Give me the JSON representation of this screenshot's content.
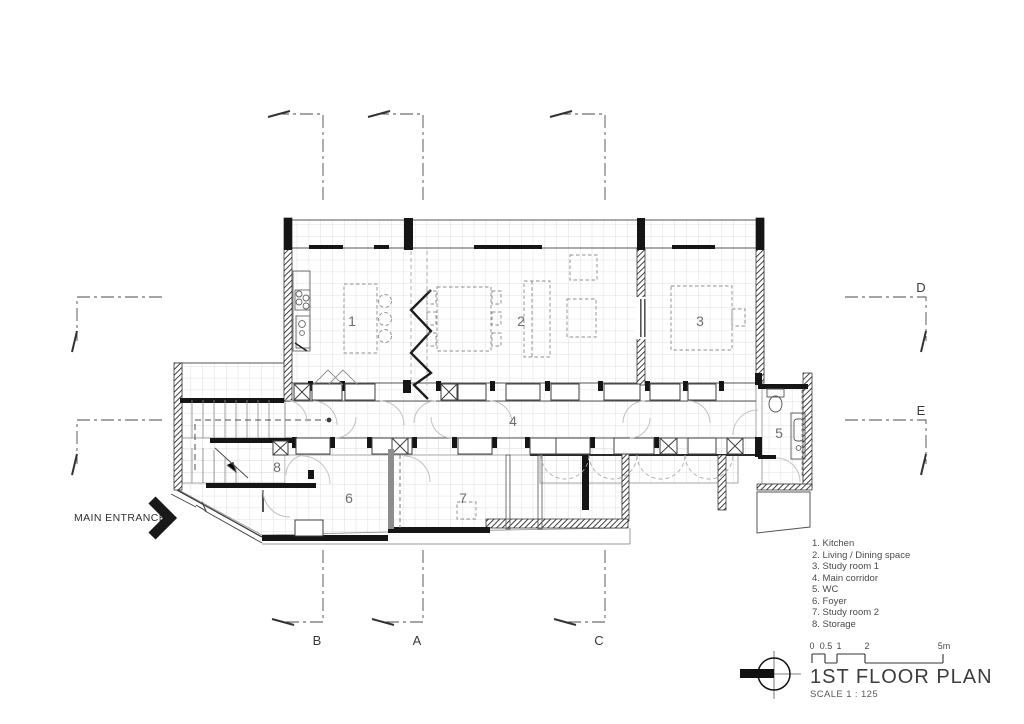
{
  "colors": {
    "background": "#ffffff",
    "line": "#3c3c3c",
    "wall": "#161616",
    "floor_grid": "#d8d8d8",
    "dashed_furniture": "#8c8c8c",
    "door_arc": "#c2c2c2"
  },
  "plan": {
    "rooms": [
      {
        "number": "1",
        "name": "Kitchen"
      },
      {
        "number": "2",
        "name": "Living / Dining space"
      },
      {
        "number": "3",
        "name": "Study room 1"
      },
      {
        "number": "4",
        "name": "Main corridor"
      },
      {
        "number": "5",
        "name": "WC"
      },
      {
        "number": "6",
        "name": "Foyer"
      },
      {
        "number": "7",
        "name": "Study room 2"
      },
      {
        "number": "8",
        "name": "Storage"
      }
    ],
    "grid_letters": {
      "bottom": [
        "B",
        "A",
        "C"
      ],
      "right": [
        "D",
        "E"
      ]
    }
  },
  "annotations": {
    "main_entrance": "MAIN ENTRANCE"
  },
  "legend": {
    "items": [
      "1. Kitchen",
      "2. Living / Dining space",
      "3. Study room 1",
      "4. Main corridor",
      "5. WC",
      "6. Foyer",
      "7. Study room 2",
      "8. Storage"
    ]
  },
  "titleblock": {
    "title": "1ST FLOOR PLAN",
    "scale_note": "SCALE 1 : 125",
    "scalebar_ticks": [
      "0",
      "0.5",
      "1",
      "2",
      "5m"
    ]
  }
}
